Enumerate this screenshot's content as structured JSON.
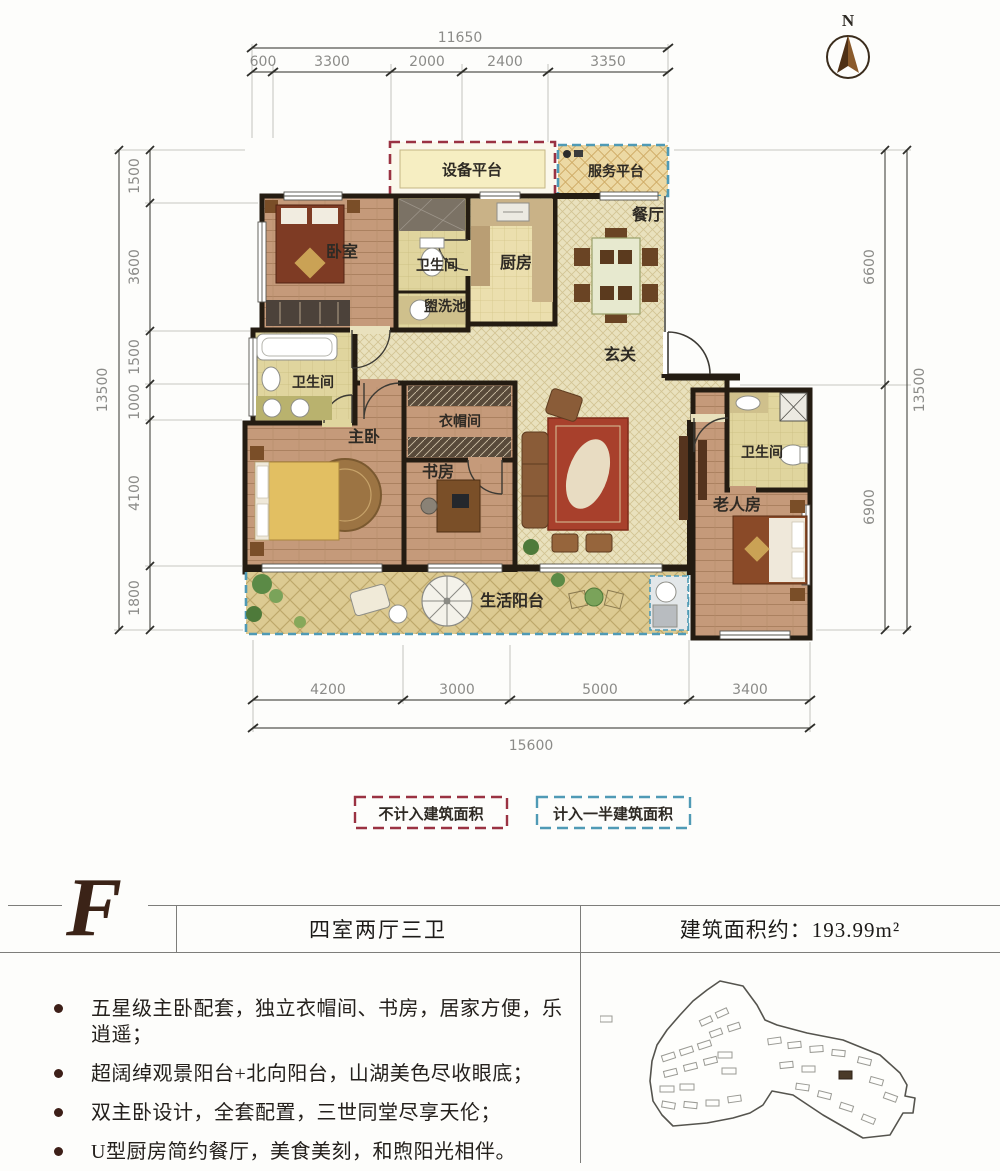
{
  "north": {
    "label": "N"
  },
  "dimensions": {
    "top": {
      "total": "11650",
      "segments": [
        "600",
        "3300",
        "2000",
        "2400",
        "3350"
      ]
    },
    "left": {
      "total": "13500",
      "segments": [
        "1500",
        "3600",
        "1500",
        "1000",
        "4100",
        "1800"
      ]
    },
    "right": {
      "total": "13500",
      "segments": [
        "6600",
        "6900"
      ]
    },
    "bottom": {
      "total": "15600",
      "segments": [
        "4200",
        "3000",
        "5000",
        "3400"
      ]
    }
  },
  "rooms": {
    "equipment_platform": "设备平台",
    "service_platform": "服务平台",
    "bedroom": "卧室",
    "bathroom_top": "卫生间",
    "washbasin": "盥洗池",
    "kitchen": "厨房",
    "dining": "餐厅",
    "foyer": "玄关",
    "bathroom_master": "卫生间",
    "master_bedroom": "主卧",
    "cloakroom": "衣帽间",
    "study": "书房",
    "bathroom_elder": "卫生间",
    "elder_room": "老人房",
    "balcony": "生活阳台"
  },
  "legend": {
    "excluded": "不计入建筑面积",
    "half_counted": "计入一半建筑面积",
    "excluded_color": "#9a3242",
    "half_color": "#4f9ab5"
  },
  "info": {
    "unit": "F",
    "layout": "四室两厅三卫",
    "area": "建筑面积约：193.99m²",
    "features": [
      "五星级主卧配套，独立衣帽间、书房，居家方便，乐逍遥；",
      "超阔绰观景阳台+北向阳台，山湖美色尽收眼底；",
      "双主卧设计，全套配置，三世同堂尽享天伦；",
      "U型厨房简约餐厅，美食美刻，和煦阳光相伴。"
    ]
  }
}
